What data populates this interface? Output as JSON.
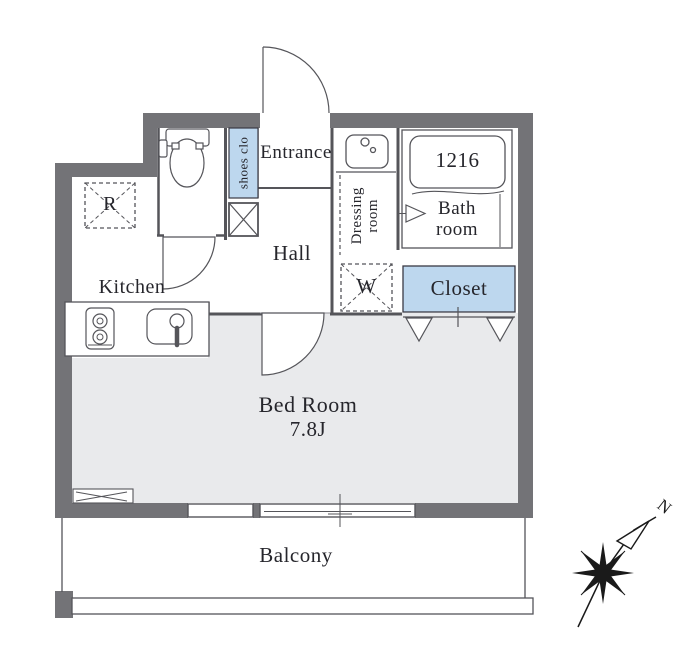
{
  "plan_title": "apartment-floor-plan",
  "rooms": {
    "entrance": {
      "label": "Entrance"
    },
    "shoes_closet": {
      "label": "shoes clo"
    },
    "hall": {
      "label": "Hall"
    },
    "dressing_room": {
      "line1": "Dressing",
      "line2": "room"
    },
    "bathroom": {
      "line1": "Bath",
      "line2": "room",
      "tub_size": "1216"
    },
    "washer_space": {
      "label": "W"
    },
    "closet": {
      "label": "Closet"
    },
    "refrigerator_space": {
      "label": "R"
    },
    "kitchen": {
      "label": "Kitchen"
    },
    "bedroom": {
      "label": "Bed Room",
      "size": "7.8J"
    },
    "balcony": {
      "label": "Balcony"
    }
  },
  "compass": {
    "north": "N"
  },
  "colors": {
    "wall": "#737377",
    "bedroom_floor": "#e9eaec",
    "closet_fill": "#bdd7ee",
    "shoes_closet_fill": "#bdd7ee",
    "line": "#55555a",
    "text": "#26262c"
  }
}
